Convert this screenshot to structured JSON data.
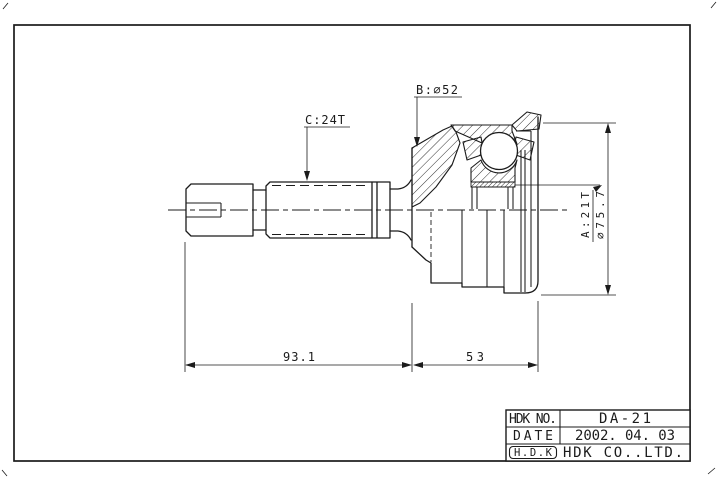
{
  "sheet": {
    "background": "#ffffff",
    "line_color": "#1b1b1b"
  },
  "annotations": {
    "spline_c_label": "C:24T",
    "diameter_b_label": "B:⌀52",
    "spline_a_label": "A:21T",
    "outer_diameter_label": "⌀75.7",
    "dim_left": "93.1",
    "dim_right": "53"
  },
  "title_block": {
    "rows": [
      {
        "label": "HDK NO.",
        "value": "DA-21"
      },
      {
        "label": "DATE",
        "value": "2002. 04. 03"
      },
      {
        "label": "H.D.K",
        "value": "HDK CO..LTD."
      }
    ]
  }
}
